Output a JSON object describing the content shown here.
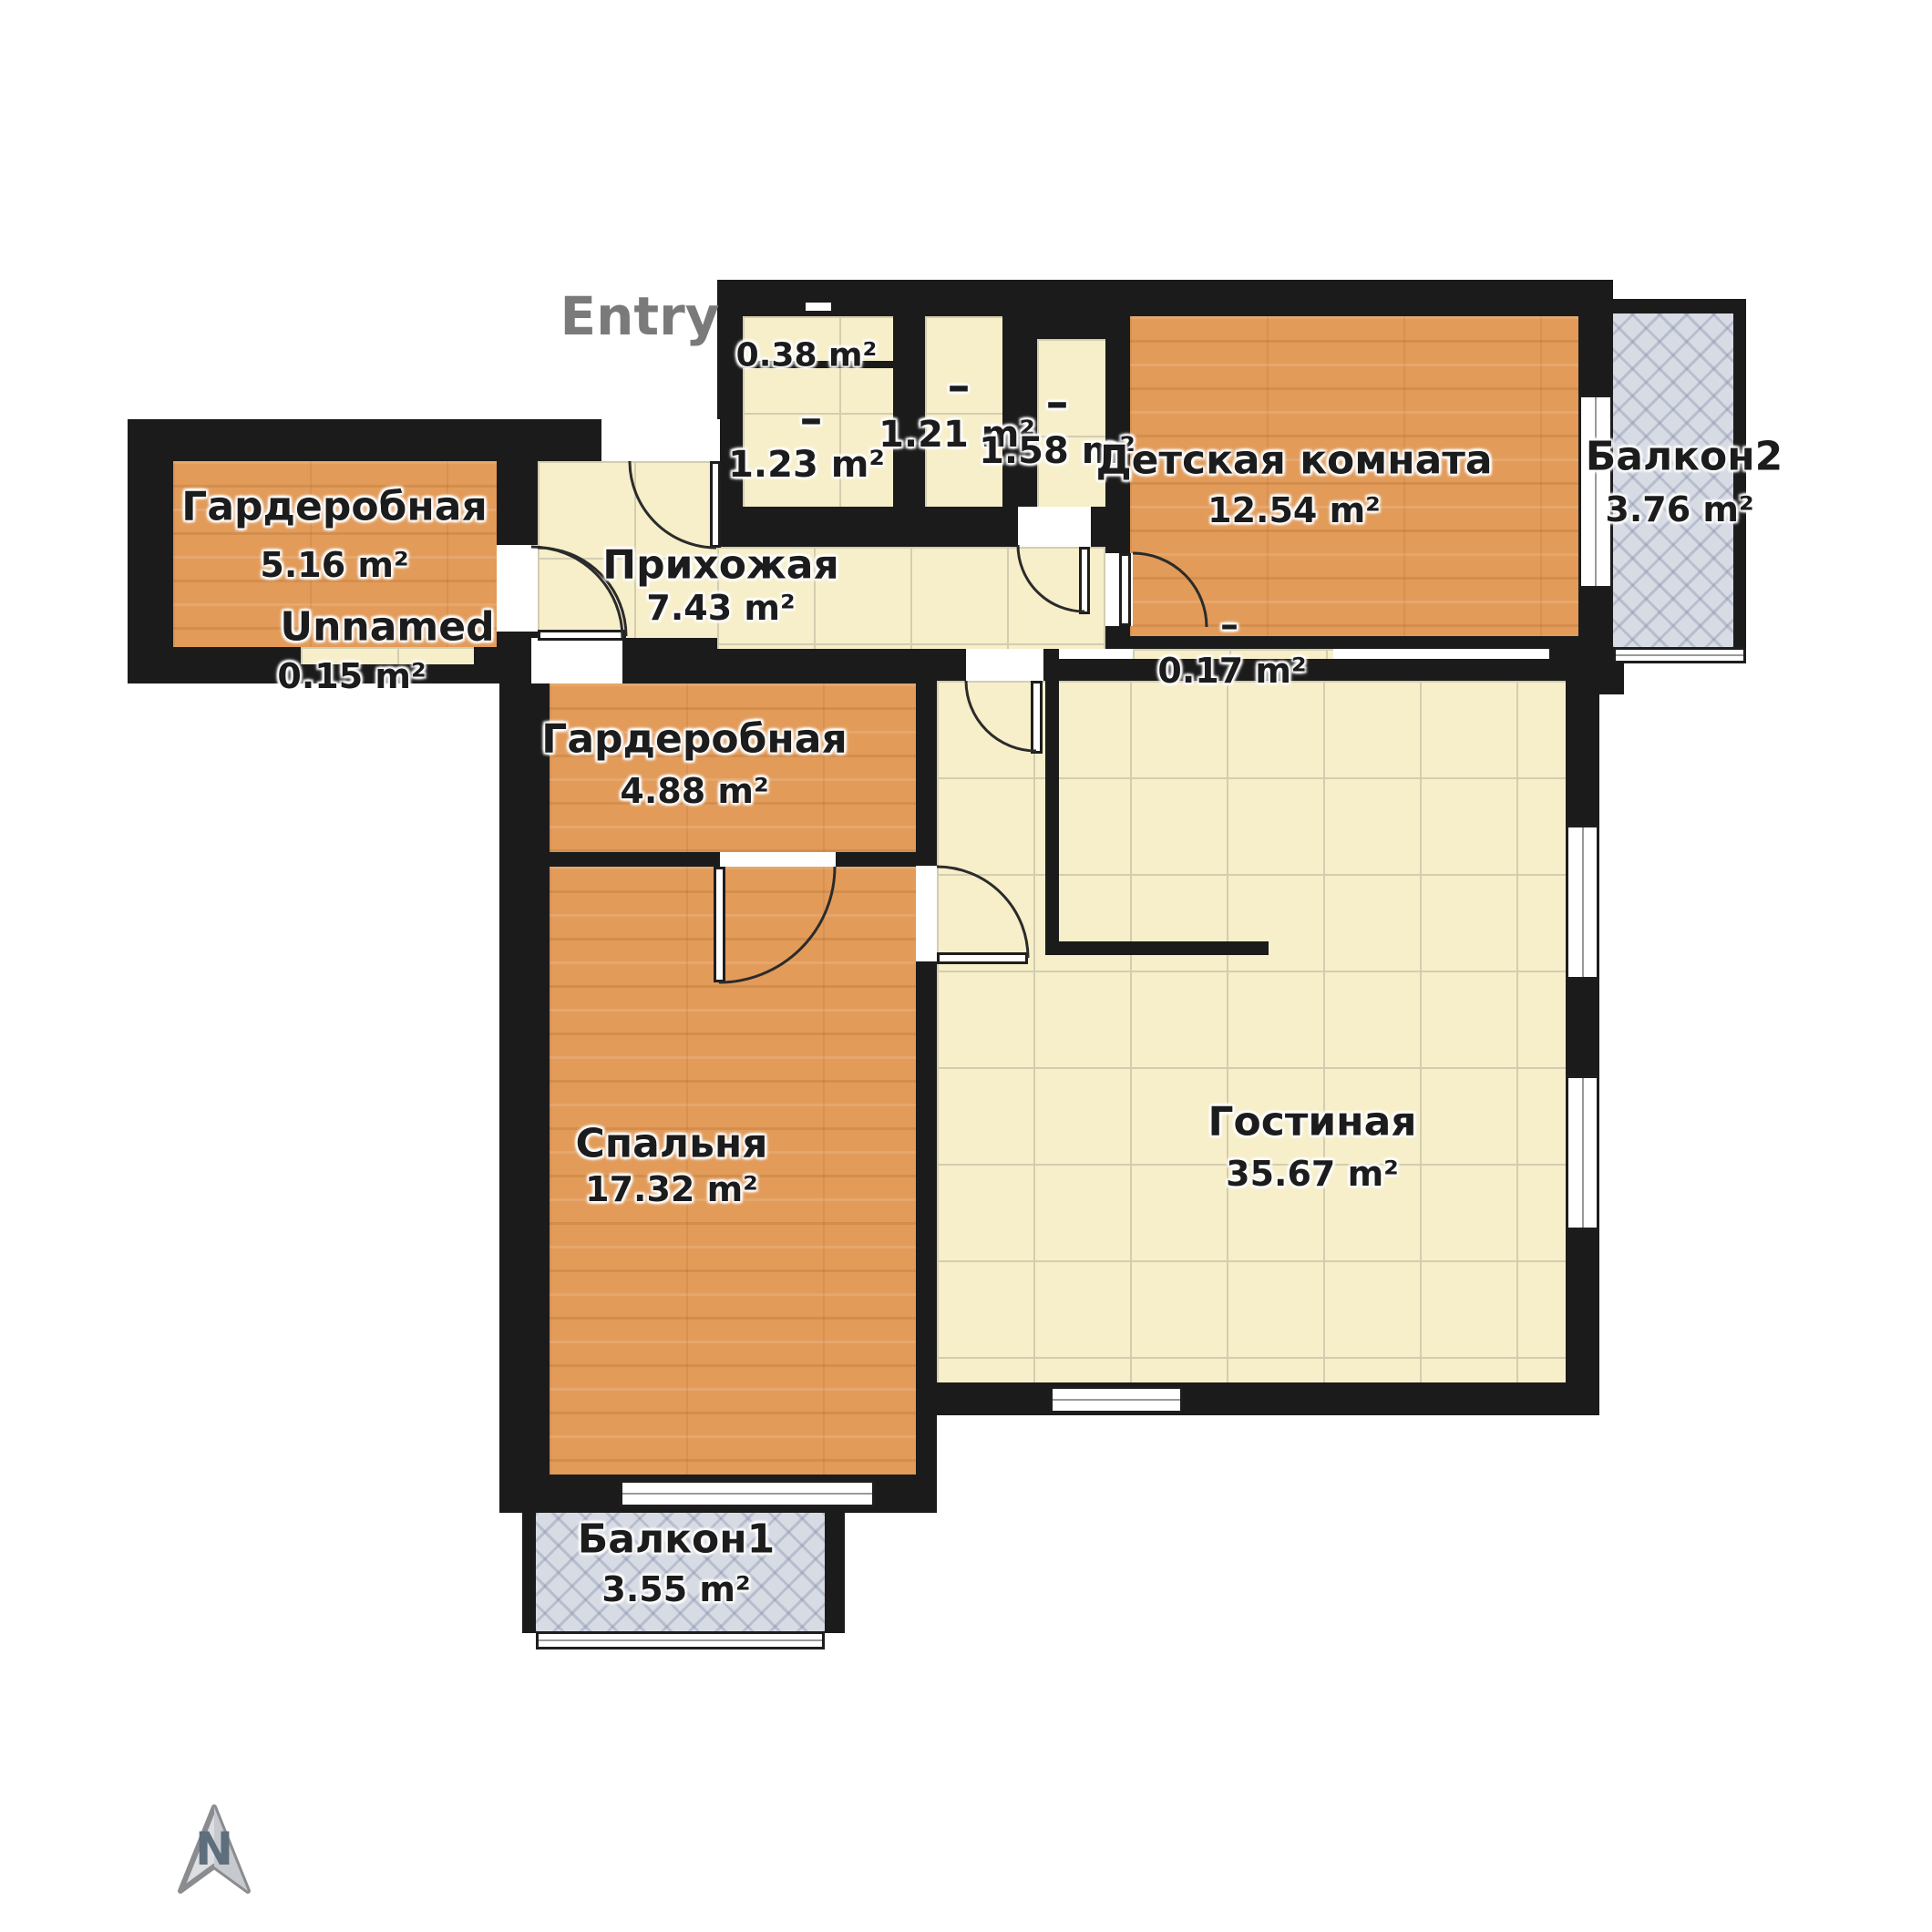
{
  "plan": {
    "entry_label": "Entry",
    "compass_letter": "N",
    "dash_label": "–",
    "rooms": {
      "wardrobe_left": {
        "name": "Гардеробная",
        "area": "5.16 m²"
      },
      "unnamed": {
        "name": "Unnamed",
        "area": "0.15 m²"
      },
      "hallway": {
        "name": "Прихожая",
        "area": "7.43 m²"
      },
      "storage_a": {
        "name": "",
        "area": "0.38 m²"
      },
      "storage_b": {
        "name": "",
        "area": "1.23 m²"
      },
      "storage_c": {
        "name": "",
        "area": "1.21 m²"
      },
      "storage_d": {
        "name": "",
        "area": "1.58 m²"
      },
      "kids_room": {
        "name": "Детская комната",
        "area": "12.54 m²"
      },
      "balcony2": {
        "name": "Балкон2",
        "area": "3.76 m²"
      },
      "wardrobe_mid": {
        "name": "Гардеробная",
        "area": "4.88 m²"
      },
      "duct": {
        "name": "",
        "area": "0.17 m²"
      },
      "living": {
        "name": "Гостиная",
        "area": "35.67 m²"
      },
      "bedroom": {
        "name": "Спальня",
        "area": "17.32 m²"
      },
      "balcony1": {
        "name": "Балкон1",
        "area": "3.55 m²"
      }
    },
    "colors": {
      "wall": "#1b1b1b",
      "tile_floor": "#f7efc9",
      "wood_floor": "#e29b59",
      "balcony_floor": "#d7dbe3",
      "label_text": "#1c1c1c",
      "entry_text": "#7a7a7a"
    }
  }
}
